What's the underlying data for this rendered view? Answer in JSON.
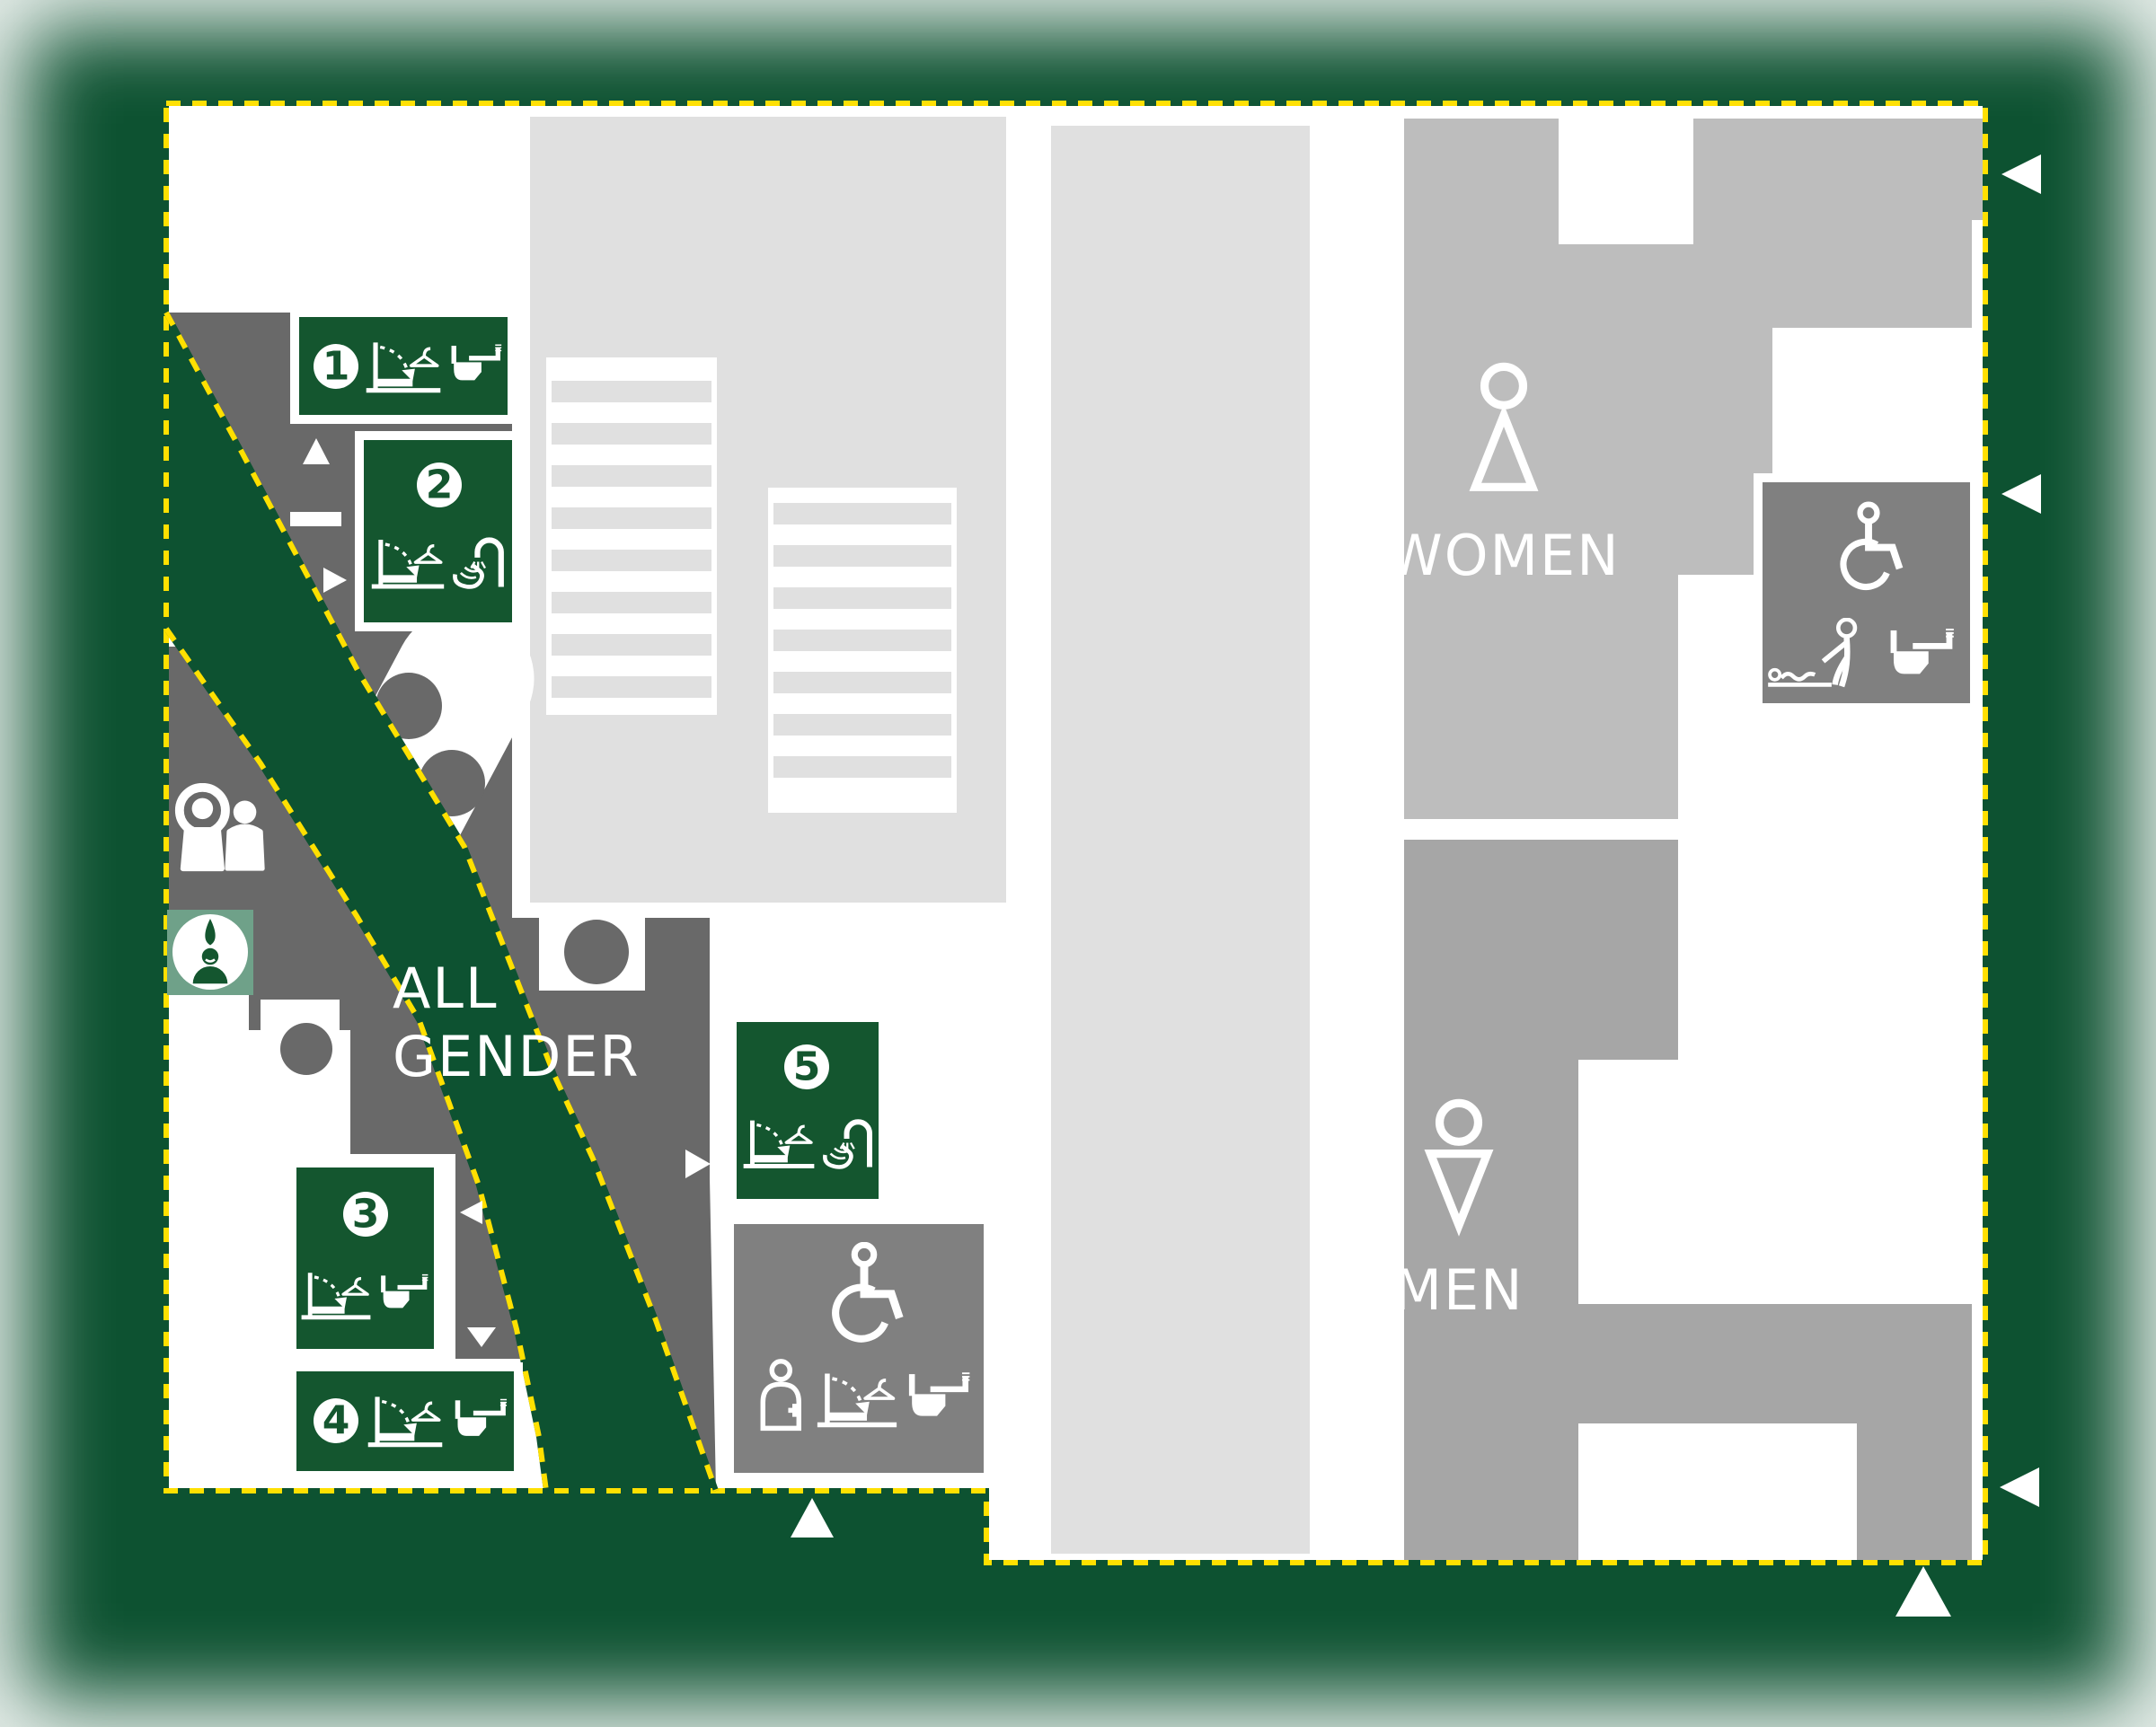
{
  "title": "Restroom facility floor plan",
  "colors": {
    "background_green": "#0d5231",
    "badge_green": "#14562f",
    "ablution_sage_green": "#6FA189",
    "boundary_yellow": "#FFE000",
    "all_gender_zone_gray": "#696969",
    "accessible_room_gray": "#808080",
    "men_zone_gray": "#a6a6a6",
    "women_zone_gray": "#bdbdbd",
    "stairs_corridor_gray": "#e0e0e0",
    "floor_white": "#ffffff"
  },
  "zones": {
    "all_gender": {
      "label": "ALL GENDER",
      "lines": [
        "ALL",
        "GENDER"
      ]
    },
    "women": {
      "label": "WOMEN",
      "symbol": "female-icon"
    },
    "men": {
      "label": "MEN",
      "symbol": "male-icon"
    }
  },
  "stations": {
    "s1": {
      "number": "1",
      "icons": [
        "baby-changing-table-icon",
        "accessible-toilet-icon"
      ]
    },
    "s2": {
      "number": "2",
      "icons": [
        "baby-changing-table-icon",
        "handwash-icon"
      ]
    },
    "s3": {
      "number": "3",
      "icons": [
        "baby-changing-table-icon",
        "accessible-toilet-icon"
      ]
    },
    "s4": {
      "number": "4",
      "icons": [
        "baby-changing-table-icon",
        "accessible-toilet-icon"
      ]
    },
    "s5": {
      "number": "5",
      "icons": [
        "baby-changing-table-icon",
        "handwash-icon"
      ]
    }
  },
  "rooms": {
    "accessible_room_center": {
      "icons": [
        "wheelchair-icon",
        "caregiver-icon",
        "baby-changing-table-icon",
        "accessible-toilet-icon"
      ]
    },
    "accessible_room_right": {
      "icons": [
        "wheelchair-icon",
        "adult-changing-table-icon",
        "accessible-toilet-icon"
      ]
    },
    "family_waiting_area": {
      "icons": [
        "family-icon"
      ]
    },
    "ablution_station": {
      "icons": [
        "ablution-icon"
      ]
    },
    "staircase": {},
    "central_corridor": {}
  },
  "arrows": [
    {
      "direction": "up",
      "location": "near-station-1"
    },
    {
      "direction": "right",
      "location": "near-station-2"
    },
    {
      "direction": "right",
      "location": "near-station-5"
    },
    {
      "direction": "left",
      "location": "near-station-3"
    },
    {
      "direction": "down",
      "location": "near-station-3"
    },
    {
      "direction": "up",
      "location": "bottom-center-entrance"
    },
    {
      "direction": "left",
      "location": "right-edge-top-entrance"
    },
    {
      "direction": "left",
      "location": "right-edge-middle-entrance"
    },
    {
      "direction": "left",
      "location": "right-edge-bottom-entrance"
    },
    {
      "direction": "up",
      "location": "bottom-right-entrance"
    }
  ]
}
